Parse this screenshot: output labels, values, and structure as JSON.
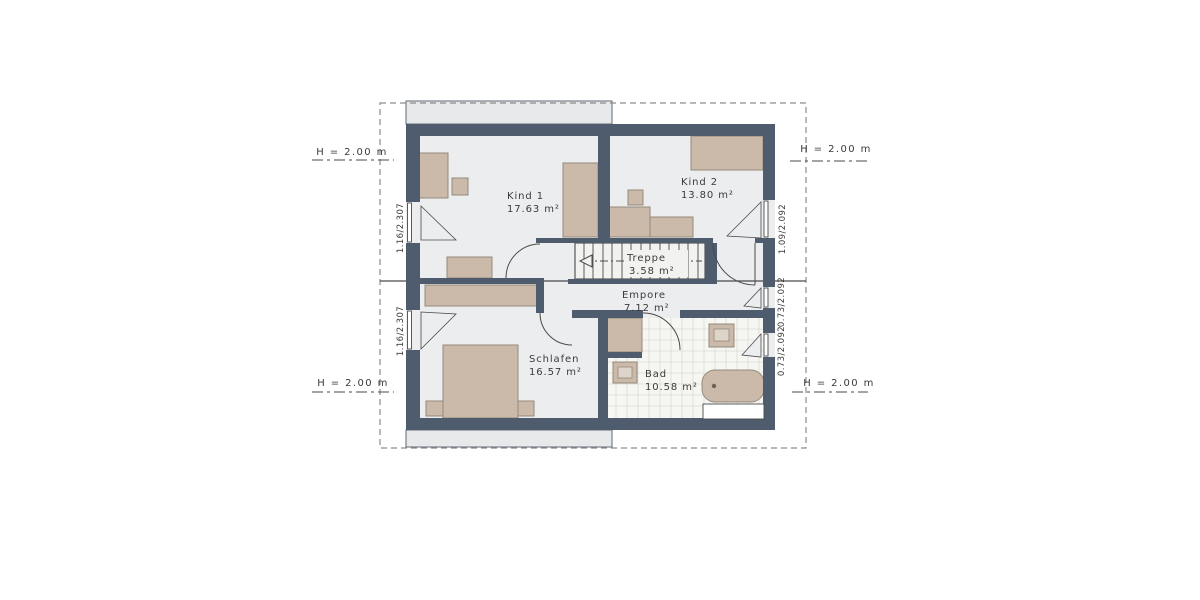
{
  "plan": {
    "type": "floor-plan",
    "rooms": [
      {
        "name": "Kind 1",
        "area": "17.63 m²"
      },
      {
        "name": "Kind 2",
        "area": "13.80 m²"
      },
      {
        "name": "Treppe",
        "area": "3.58 m²"
      },
      {
        "name": "Empore",
        "area": "7.12 m²"
      },
      {
        "name": "Schlafen",
        "area": "16.57 m²"
      },
      {
        "name": "Bad",
        "area": "10.58 m²"
      }
    ]
  },
  "height_markers": {
    "top_left": "H = 2.00 m",
    "top_right": "H = 2.00 m",
    "bottom_left": "H = 2.00 m",
    "bottom_right": "H = 2.00 m"
  },
  "dimensions": {
    "left_top": "1.16/2.307",
    "left_bottom": "1.16/2.307",
    "right_top": "1.09/2.092",
    "right_middle": "0.73/2.092",
    "right_bottom": "0.73/2.092"
  },
  "colors": {
    "wall": "#4e5c6e",
    "floor": "#ecedef",
    "stair_floor": "#f2f2f0",
    "tile_bg": "#f6f6f3",
    "tile_line": "#dbdbd5",
    "furniture": "#cbbaa9",
    "furniture_inner": "#ded5ca",
    "furniture_border": "#96897b",
    "roof": "#e8e9ea",
    "roof_border": "#5f6a76",
    "dash": "#8c8c8c",
    "line": "#4a4a4a",
    "text": "#3b3b3b"
  }
}
